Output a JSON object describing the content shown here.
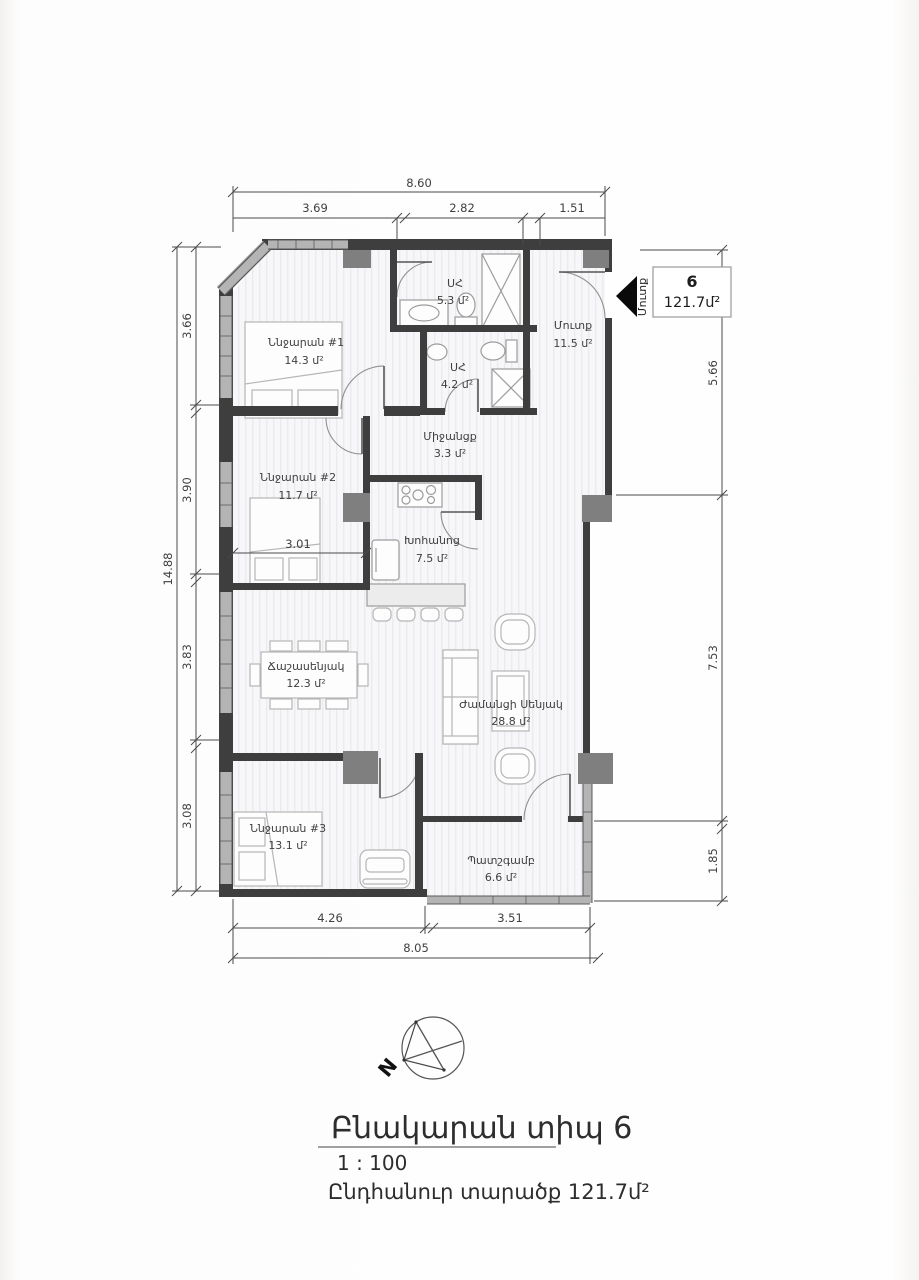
{
  "unit_box": {
    "number": "6",
    "area": "121.7մ²"
  },
  "entry": {
    "label": "Մուտք"
  },
  "rooms": {
    "bedroom1": {
      "label": "Ննջարան #1",
      "area": "14.3 մ²"
    },
    "bedroom2": {
      "label": "Ննջարան #2",
      "area": "11.7 մ²"
    },
    "bedroom3": {
      "label": "Ննջարան #3",
      "area": "13.1 մ²"
    },
    "bath1": {
      "label": "ՍՀ",
      "area": "5.3 մ²"
    },
    "bath2": {
      "label": "ՍՀ",
      "area": "4.2 մ²"
    },
    "hall": {
      "label": "Մուտք",
      "area": "11.5 մ²"
    },
    "corridor": {
      "label": "Միջանցք",
      "area": "3.3 մ²"
    },
    "kitchen": {
      "label": "Խոհանոց",
      "area": "7.5 մ²"
    },
    "dining": {
      "label": "Ճաշասենյակ",
      "area": "12.3 մ²"
    },
    "living": {
      "label": "Ժամանցի Սենյակ",
      "area": "28.8 մ²"
    },
    "balcony": {
      "label": "Պատշգամբ",
      "area": "6.6 մ²"
    }
  },
  "dims": {
    "top_overall": "8.60",
    "top_1": "3.69",
    "top_2": "2.82",
    "top_3": "1.51",
    "left_overall": "14.88",
    "left_1": "3.66",
    "left_2": "3.90",
    "left_3": "3.83",
    "left_4": "3.08",
    "right_1": "5.66",
    "right_2": "7.53",
    "right_3": "1.85",
    "bottom_1": "4.26",
    "bottom_2": "3.51",
    "bottom_overall": "8.05",
    "interior_1": "3.01"
  },
  "compass": {
    "label": "N"
  },
  "title_block": {
    "title": "Բնակարան տիպ 6",
    "scale": "1 : 100",
    "total": "Ընդհանուր տարածք 121.7մ²"
  },
  "colors": {
    "wall": "#3e3e3e",
    "window": "#b4b4b4",
    "pillar": "#7f7f7f",
    "dim": "#3f3f3f",
    "furniture": "#b6b6b6"
  }
}
